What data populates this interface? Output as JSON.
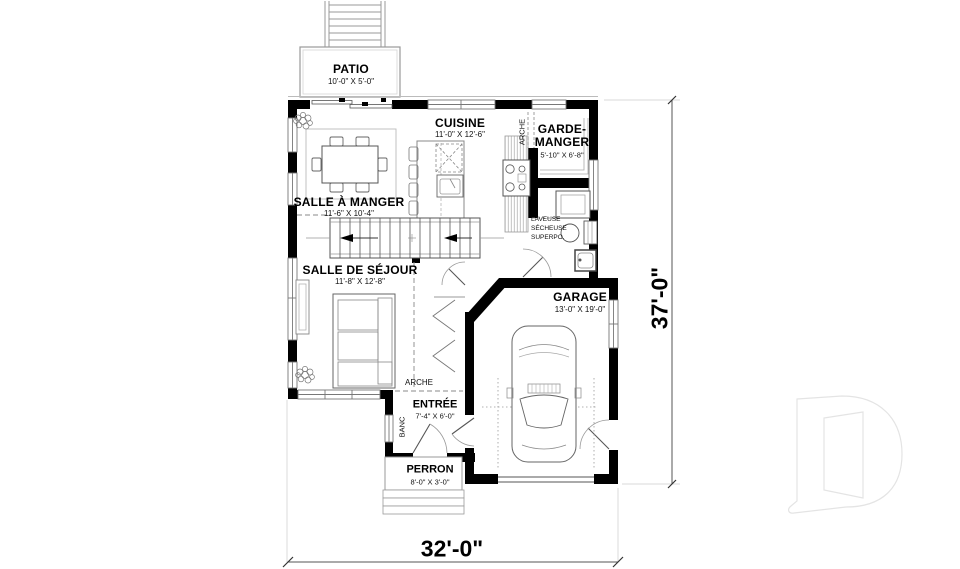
{
  "plan": {
    "rooms": {
      "patio": {
        "name": "PATIO",
        "dims": "10'-0\" X 5'-0\""
      },
      "cuisine": {
        "name": "CUISINE",
        "dims": "11'-0\" X 12'-6\""
      },
      "garde_manger": {
        "name_line1": "GARDE-",
        "name_line2": "MANGER",
        "dims": "5'-10\" X 6'-8\""
      },
      "salle_a_manger": {
        "name": "SALLE À MANGER",
        "dims": "11'-6\" X 10'-4\""
      },
      "salle_de_sejour": {
        "name": "SALLE DE SÉJOUR",
        "dims": "11'-8\" X 12'-8\""
      },
      "garage": {
        "name": "GARAGE",
        "dims": "13'-0\" X 19'-0\""
      },
      "entree": {
        "name": "ENTRÉE",
        "dims": "7'-4\" X 6'-0\""
      },
      "perron": {
        "name": "PERRON",
        "dims": "8'-0\" X 3'-0\""
      }
    },
    "annotations": {
      "arche_upper": "ARCHE",
      "arche_lower": "ARCHE",
      "banc": "BANC",
      "laundry": [
        "LAVEUSE",
        "SÉCHEUSE",
        "SUPERPO."
      ]
    },
    "dimensions": {
      "width": "32'-0\"",
      "height": "37'-0\""
    },
    "colors": {
      "wall": "#000000",
      "line": "#555555",
      "background": "#ffffff",
      "watermark": "#e4e4e4"
    }
  }
}
